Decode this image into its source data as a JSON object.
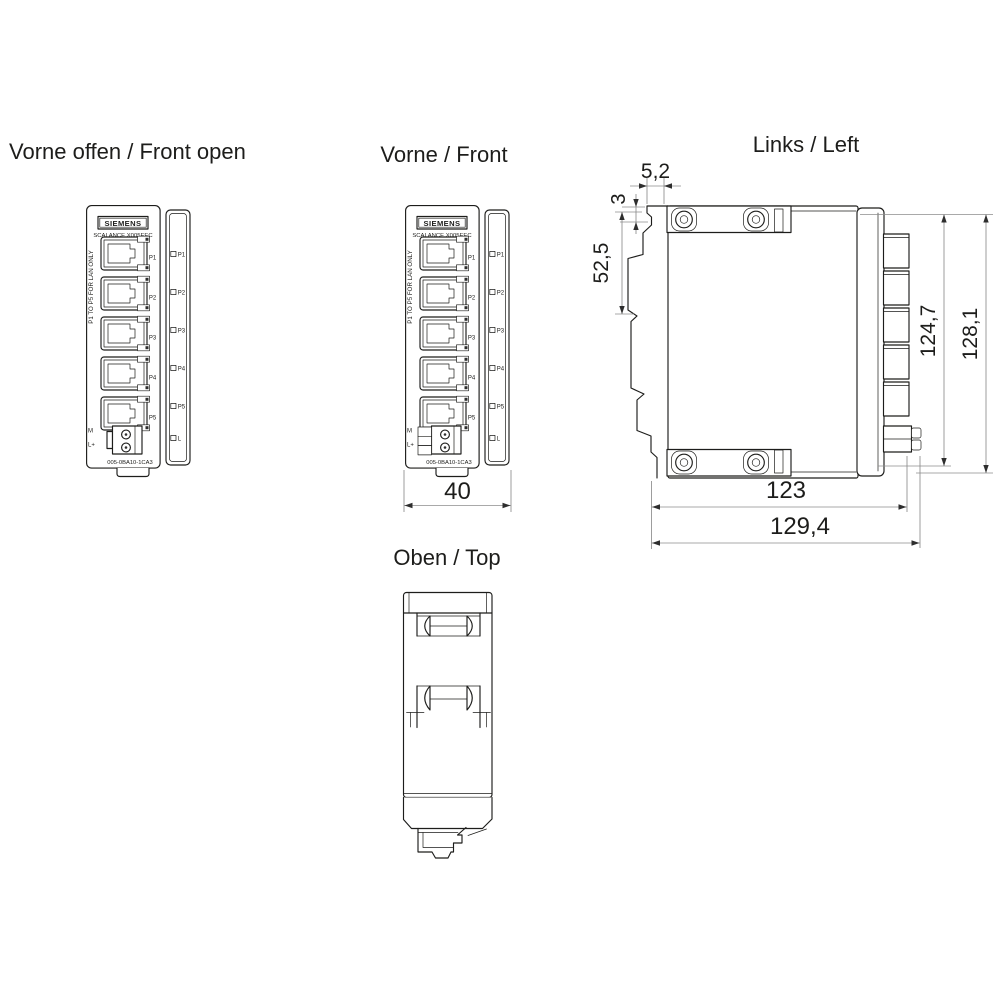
{
  "titles": {
    "front_open": "Vorne offen / Front open",
    "front": "Vorne / Front",
    "left": "Links / Left",
    "top": "Oben / Top"
  },
  "device": {
    "brand": "SIEMENS",
    "model": "SCALANCE X005EEC",
    "port_note": "P1 TO P5 FOR LAN ONLY",
    "ports": [
      "P1",
      "P2",
      "P3",
      "P4",
      "P5"
    ],
    "leds": [
      "P1",
      "P2",
      "P3",
      "P4",
      "P5",
      "L"
    ],
    "power": [
      "M",
      "L+"
    ],
    "order_number": "005-0BA10-1CA3"
  },
  "dimensions": {
    "front_width": "40",
    "rail_tab_width": "5,2",
    "rail_tab_height": "3",
    "rail_upper_height": "52,5",
    "body_height": "124,7",
    "total_height": "128,1",
    "body_depth": "123",
    "total_depth": "129,4"
  },
  "colors": {
    "line": "#1d1d1b",
    "dimension_line": "#8c8c8c",
    "background": "#ffffff"
  }
}
